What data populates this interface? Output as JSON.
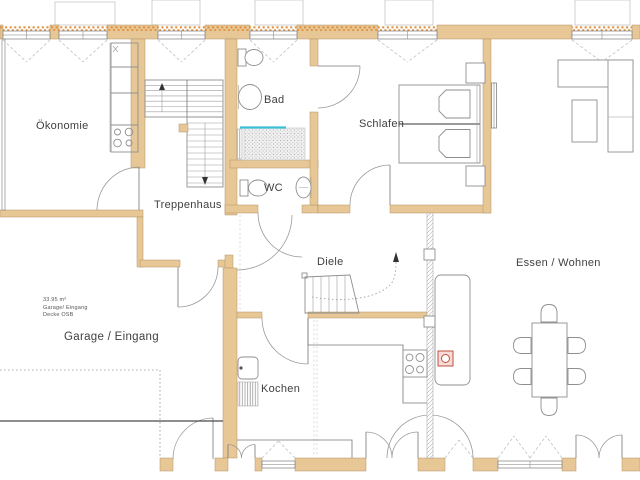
{
  "rooms": {
    "okonomie": "Ökonomie",
    "bad": "Bad",
    "wc": "WC",
    "schlafen": "Schlafen",
    "treppenhaus": "Treppenhaus",
    "diele": "Diele",
    "kochen": "Kochen",
    "essen_wohnen": "Essen / Wohnen",
    "garage_eingang": "Garage / Eingang"
  },
  "garage_note": {
    "area": "33.95 m²",
    "usage": "Garage/ Eingang",
    "ceiling": "Decke OSB"
  },
  "colors": {
    "wall": "#e7c795",
    "lintel": "#e09140",
    "accent": "#3bbfd4",
    "chimney": "#c0503e",
    "line": "#8f8f8f"
  },
  "fixtures": [
    "stairs",
    "cellar-stairs",
    "toilet",
    "sink",
    "shower",
    "radiator",
    "washing-machine",
    "stove",
    "kitchen-sink",
    "bed",
    "nightstand",
    "sofa",
    "coffee-table",
    "dining-table",
    "chairs",
    "tiled-stove",
    "chimney",
    "glass-partition"
  ]
}
